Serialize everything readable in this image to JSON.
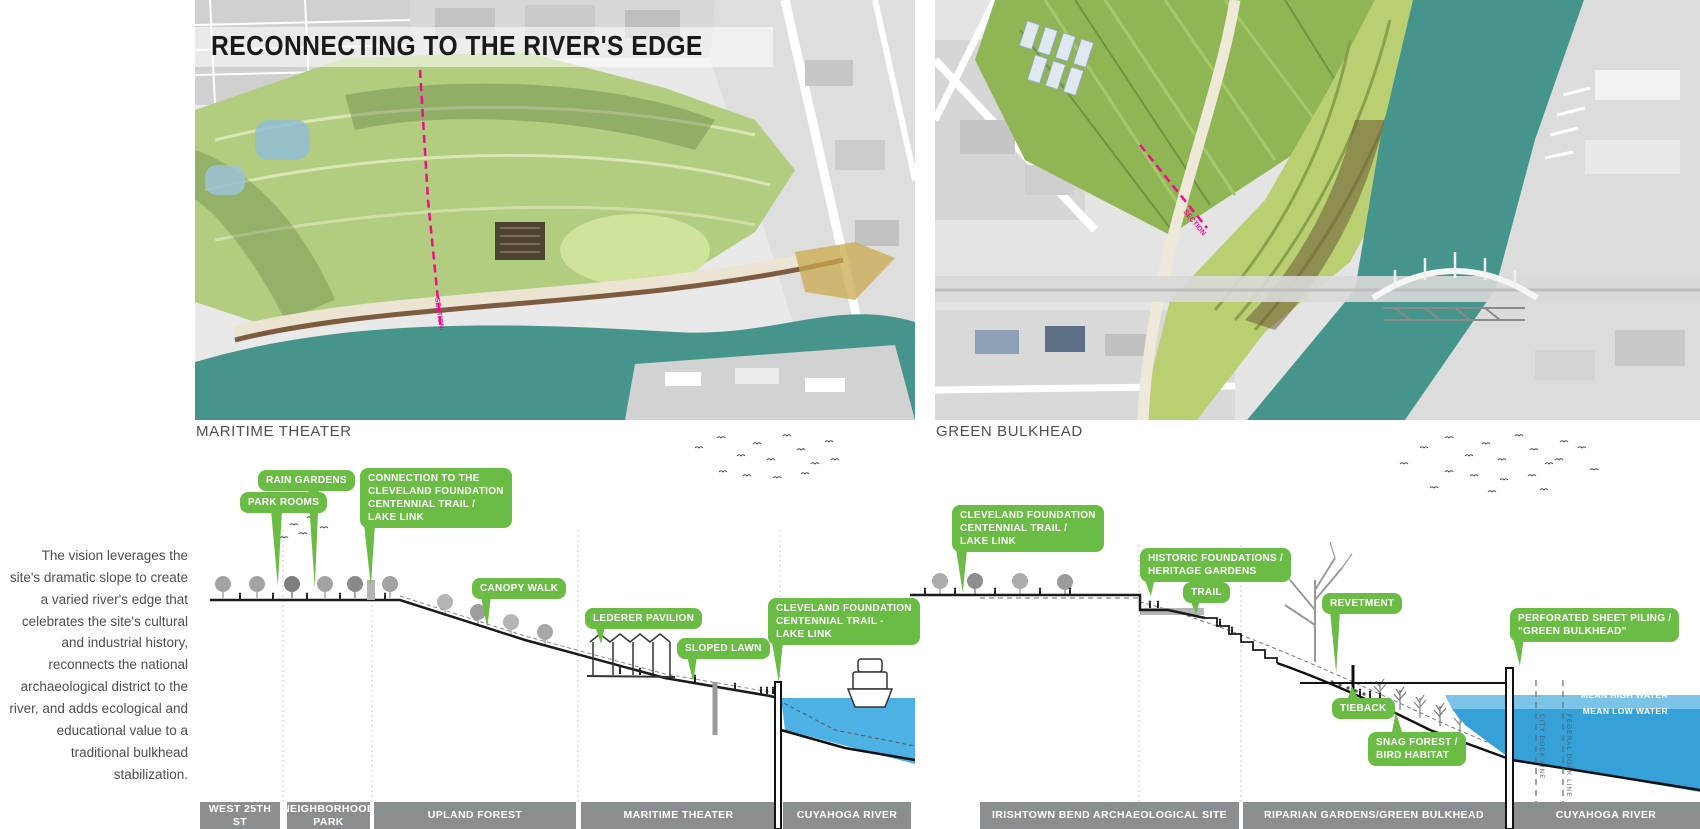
{
  "title": "RECONNECTING TO THE RIVER'S EDGE",
  "intro_text": "The vision leverages the site's dramatic slope to create a varied river's edge that celebrates the site's cultural and industrial history, reconnects the national archaeological district to the river, and adds ecological and educational value to a traditional bulkhead stabilization.",
  "aerials": {
    "left_caption": "MARITIME THEATER",
    "right_caption": "GREEN BULKHEAD",
    "section_label": "SECTION"
  },
  "left_section": {
    "callouts": [
      {
        "text": "RAIN GARDENS"
      },
      {
        "text": "PARK ROOMS"
      },
      {
        "text": "CONNECTION TO THE\nCLEVELAND FOUNDATION\nCENTENNIAL TRAIL /\nLAKE LINK"
      },
      {
        "text": "CANOPY WALK"
      },
      {
        "text": "LEDERER PAVILION"
      },
      {
        "text": "SLOPED LAWN"
      },
      {
        "text": "CLEVELAND FOUNDATION\nCENTENNIAL TRAIL -\nLAKE LINK"
      }
    ],
    "zones": [
      {
        "label": "WEST 25TH ST"
      },
      {
        "label": "NEIGHBORHOOD PARK"
      },
      {
        "label": "UPLAND FOREST"
      },
      {
        "label": "MARITIME THEATER"
      },
      {
        "label": "CUYAHOGA RIVER"
      }
    ]
  },
  "right_section": {
    "callouts": [
      {
        "text": "CLEVELAND FOUNDATION\nCENTENNIAL TRAIL /\nLAKE LINK"
      },
      {
        "text": "HISTORIC FOUNDATIONS /\nHERITAGE GARDENS"
      },
      {
        "text": "TRAIL"
      },
      {
        "text": "REVETMENT"
      },
      {
        "text": "PERFORATED SHEET PILING /\n\"GREEN BULKHEAD\""
      },
      {
        "text": "TIEBACK"
      },
      {
        "text": "SNAG FOREST /\nBIRD HABITAT"
      }
    ],
    "water_labels": [
      {
        "text": "MEAN HIGH WATER"
      },
      {
        "text": "MEAN LOW WATER"
      }
    ],
    "dock_lines": [
      {
        "text": "CITY DOCK LINE"
      },
      {
        "text": "FEDERAL DOCK LINE"
      }
    ],
    "zones": [
      {
        "label": "IRISHTOWN BEND ARCHAEOLOGICAL SITE"
      },
      {
        "label": "RIPARIAN GARDENS/GREEN BULKHEAD"
      },
      {
        "label": "CUYAHOGA RIVER"
      }
    ]
  },
  "colors": {
    "callout_green": "#6abc45",
    "zone_bar_gray": "#8b8e90",
    "water_light_blue": "#7cc3e8",
    "water_deep_blue": "#36a0d8",
    "river_teal": "#47948c",
    "section_line_pink": "#ef0e8b",
    "title_black": "#1a1a1a"
  }
}
